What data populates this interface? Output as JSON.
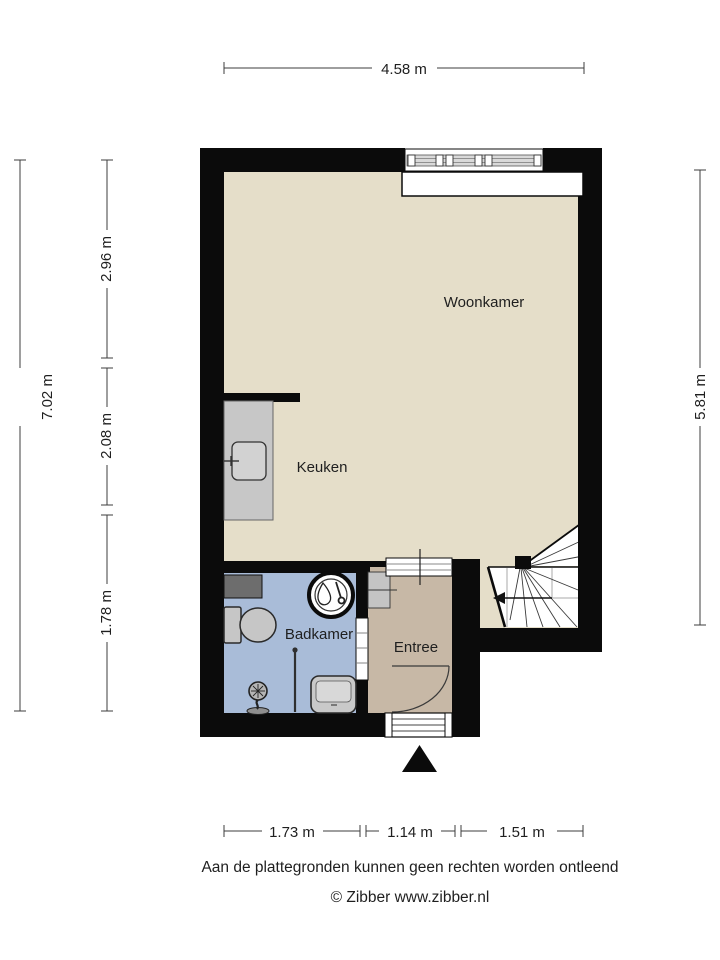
{
  "plan": {
    "rooms": [
      {
        "id": "woonkamer",
        "label": "Woonkamer"
      },
      {
        "id": "keuken",
        "label": "Keuken"
      },
      {
        "id": "badkamer",
        "label": "Badkamer"
      },
      {
        "id": "entree",
        "label": "Entree"
      }
    ],
    "fixtures": [
      "window",
      "window-sill",
      "kitchen-counter",
      "kitchen-sink",
      "boiler-circle",
      "toilet",
      "shower-fixture",
      "shower-rail",
      "washbasin",
      "meter-cupboard",
      "utility-box",
      "winder-stairs",
      "stair-direction-arrow",
      "entrance-door-swing",
      "door-threshold",
      "bathroom-door",
      "passage-opening",
      "entrance-marker-triangle"
    ]
  },
  "dimensions": {
    "top": "4.58 m",
    "left_total": "7.02 m",
    "left_segments": [
      "2.96 m",
      "2.08 m",
      "1.78 m"
    ],
    "right": "5.81 m",
    "bottom_segments": [
      "1.73 m",
      "1.14 m",
      "1.51 m"
    ]
  },
  "footer": {
    "disclaimer": "Aan de plattegronden kunnen geen rechten worden ontleend",
    "copyright": "© Zibber www.zibber.nl"
  },
  "colors": {
    "wall": "#0b0b0b",
    "floor_living": "#e5dec9",
    "floor_bathroom": "#a9bcd8",
    "floor_hall": "#c7b8a6",
    "counter": "#c7c7c7",
    "fixture_fill": "#c9c9c9",
    "text": "#1f1f1f"
  }
}
